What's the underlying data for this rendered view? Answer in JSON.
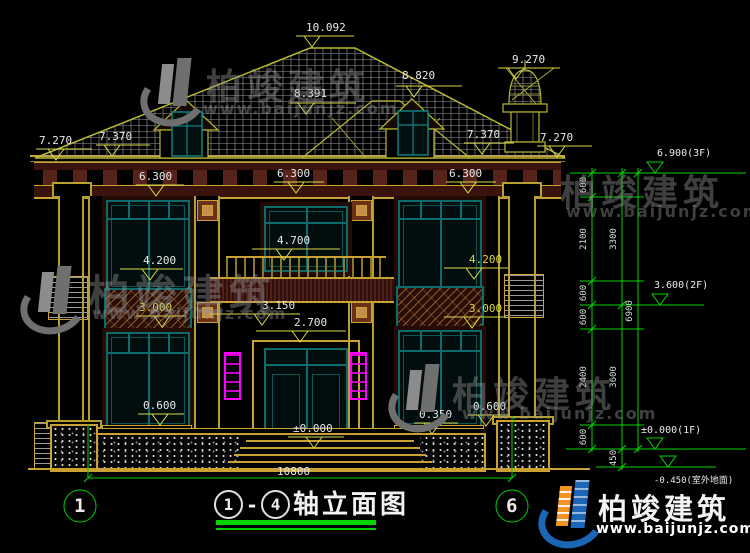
{
  "brand": {
    "name": "柏竣建筑",
    "url": "www.baijunjz.com"
  },
  "title": {
    "axis_from": "1",
    "dash": "-",
    "axis_to": "4",
    "text": "轴立面图"
  },
  "axis_bubbles": {
    "left": "1",
    "right": "6"
  },
  "dims": {
    "overall_width": "10800"
  },
  "marks": {
    "m10092": "10.092",
    "m9270": "9.270",
    "m8820": "8.820",
    "m8391": "8.391",
    "m7370_l": "7.370",
    "m7270_l": "7.270",
    "m7370_r": "7.370",
    "m7270_r": "7.270",
    "m6300_l": "6.300",
    "m6300_c": "6.300",
    "m6300_r": "6.300",
    "m4700": "4.700",
    "m4200_l": "4.200",
    "m4200_r": "4.200",
    "m3150": "3.150",
    "m2700": "2.700",
    "m3000_l": "3.000",
    "m3000_r": "3.000",
    "m0600_l": "0.600",
    "m0350": "0.350",
    "m0600_r": "0.600",
    "m0000": "±0.000"
  },
  "chain": {
    "level_3f": "6.900(3F)",
    "level_2f": "3.600(2F)",
    "level_1f": "±0.000(1F)",
    "level_ground": "-0.450(室外地面)",
    "seg_600_a": "600",
    "seg_2100": "2100",
    "seg_600_b": "600",
    "seg_600_c": "600",
    "seg_2400": "2400",
    "seg_600_d": "600",
    "seg_3300": "3300",
    "seg_3600": "3600",
    "seg_450": "450",
    "total_6900": "6900"
  }
}
